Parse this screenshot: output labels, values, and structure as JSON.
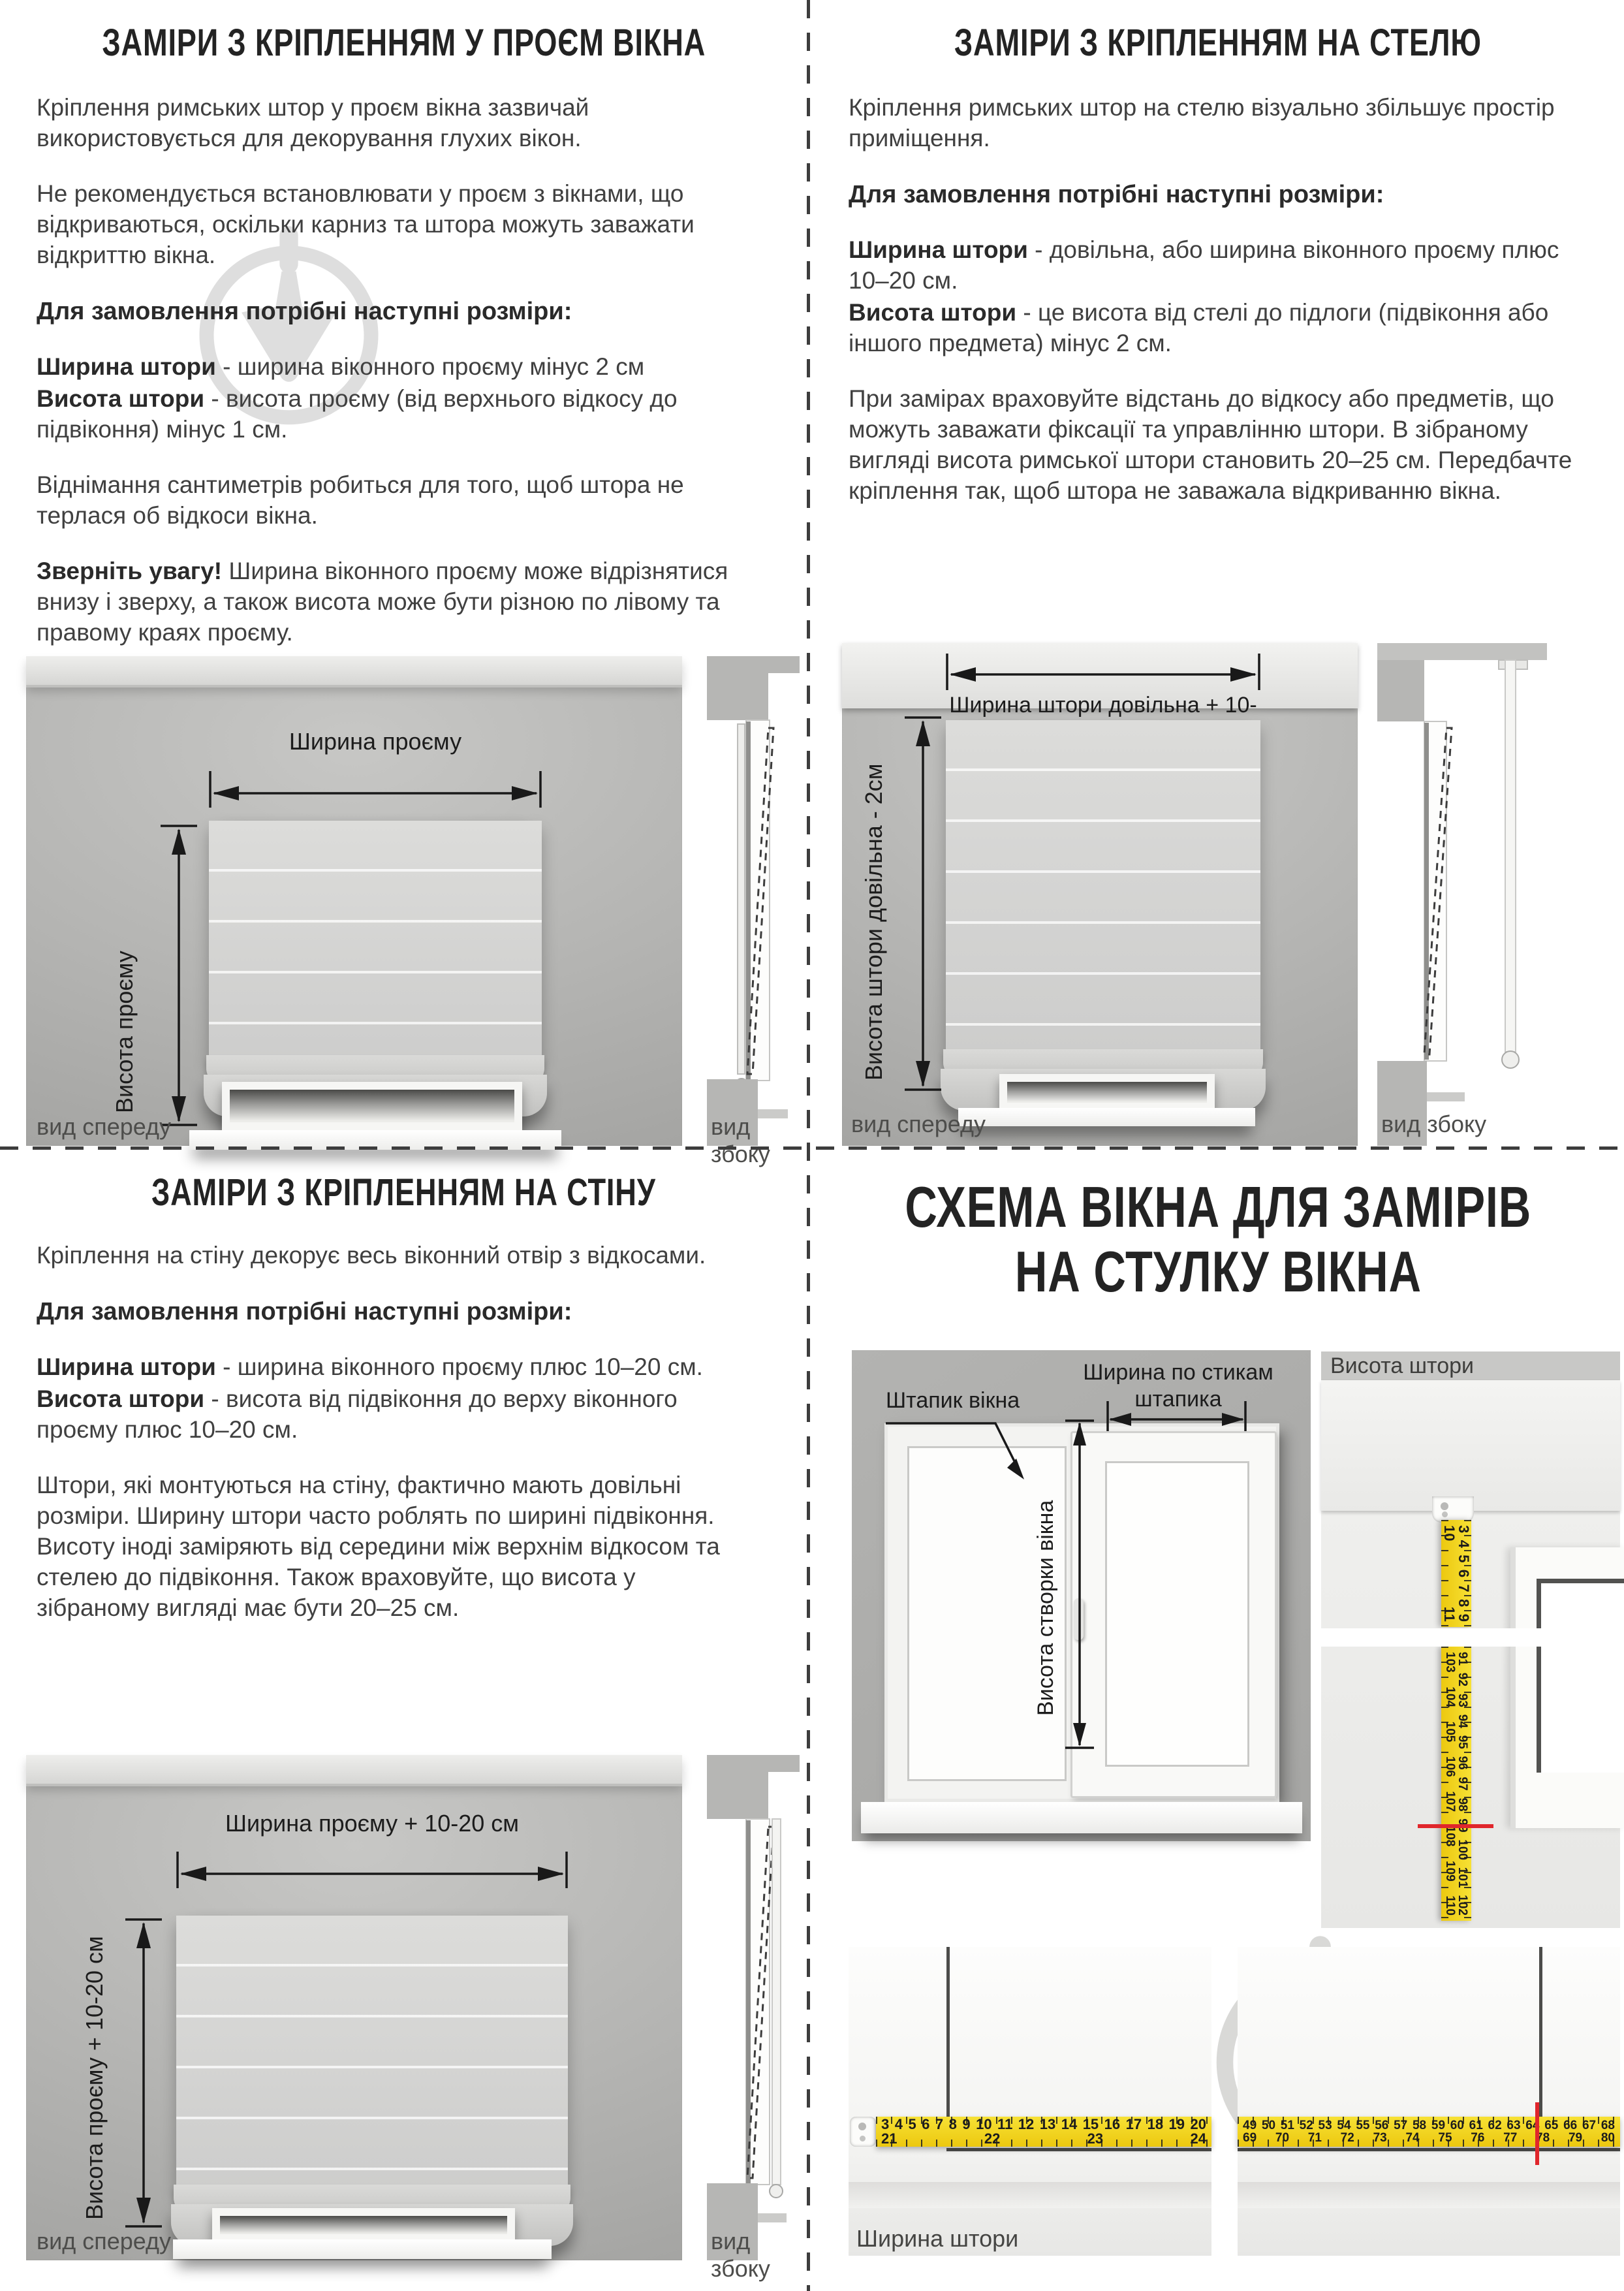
{
  "sections": {
    "opening": {
      "title": "ЗАМІРИ З КРІПЛЕННЯМ У ПРОЄМ ВІКНА",
      "intro": "Кріплення римських штор у проєм вікна зазвичай використовується для декорування глухих вікон.",
      "caution": "Не рекомендується встановлювати у проєм з вікнами, що відкриваються, оскільки карниз та штора можуть заважати відкриттю вікна.",
      "order_heading": "Для замовлення потрібні наступні розміри:",
      "sizes": [
        {
          "term": "Ширина штори",
          "desc": " - ширина віконного проєму мінус 2 см"
        },
        {
          "term": "Висота штори",
          "desc": " - висота проєму (від верхнього відкосу до підвіконня) мінус 1 см."
        }
      ],
      "explain": "Віднімання сантиметрів робиться для того, щоб штора не терлася об відкоси вікна.",
      "attention_lead": "Зверніть увагу!",
      "attention_text": " Ширина віконного проєму може відрізнятися внизу і зверху, а також висота може бути різною по лівому та правому краях проєму.",
      "dim_width_label": "Ширина проєму",
      "dim_height_label": "Висота проєму",
      "front_view_caption": "вид спереду",
      "side_view_caption": "вид збоку"
    },
    "ceiling": {
      "title": "ЗАМІРИ З КРІПЛЕННЯМ НА СТЕЛЮ",
      "intro": "Кріплення римських штор на стелю візуально збільшує простір приміщення.",
      "order_heading": "Для замовлення потрібні наступні розміри:",
      "sizes": [
        {
          "term": "Ширина штори",
          "desc": " - довільна, або ширина віконного проєму плюс 10–20 см."
        },
        {
          "term": "Висота штори",
          "desc": " - це висота від стелі до підлоги (підвіконня або іншого предмета) мінус 2 см."
        }
      ],
      "tips": "При замірах враховуйте відстань до відкосу або предметів, що можуть заважати фіксації та управлінню штори. В зібраному вигляді висота римської штори становить 20–25 см. Передбачте кріплення так, щоб штора не заважала відкриванню вікна.",
      "dim_width_label": "Ширина штори довільна + 10-20 см",
      "dim_height_label": "Висота штори довільна - 2см",
      "front_view_caption": "вид спереду",
      "side_view_caption": "вид збоку"
    },
    "wall": {
      "title": "ЗАМІРИ З КРІПЛЕННЯМ НА СТІНУ",
      "intro": "Кріплення на стіну декорує весь віконний отвір з відкосами.",
      "order_heading": "Для замовлення потрібні наступні розміри:",
      "sizes": [
        {
          "term": "Ширина штори",
          "desc": " - ширина віконного проєму плюс 10–20 см."
        },
        {
          "term": "Висота штори",
          "desc": " - висота від підвіконня до верху віконного проєму плюс 10–20 см."
        }
      ],
      "tips": "Штори, які монтуються на стіну, фактично мають довільні розміри. Ширину штори часто роблять по ширині підвіконня. Висоту іноді заміряють від середини між верхнім відкосом та стелею до підвіконня. Також враховуйте, що висота у зібраному вигляді має бути 20–25 см.",
      "dim_width_label": "Ширина проєму + 10-20 см",
      "dim_height_label": "Висота проєму + 10-20 см",
      "front_view_caption": "вид спереду",
      "side_view_caption": "вид збоку"
    },
    "sash": {
      "title_line1": "СХЕМА ВІКНА ДЛЯ ЗАМІРІВ",
      "title_line2": "НА СТУЛКУ ВІКНА",
      "bead_label": "Штапик вікна",
      "bead_width_label_line1": "Ширина по стикам",
      "bead_width_label_line2": "штапика",
      "sash_height_label": "Висота створки вікна",
      "curtain_height_label": "Висота штори",
      "curtain_width_label": "Ширина штори",
      "tape_vertical_top": "3 4 5 6 7 8 9 10 11",
      "tape_vertical_bottom": "91 92 93 94 95 96 97 98 99 100 101 102 103 104 105 106 107 108 109 110",
      "tape_horizontal_left": "3 4 5 6 7 8 9 10 11 12 13 14 15 16 17 18 19 20 21 22 23 24",
      "tape_horizontal_right": "49 50 51 52 53 54 55 56 57 58 59 60 61 62 63 64 65 66 67 68 69 70 71 72 73 74 75 76 77 78 79 80"
    }
  },
  "colors": {
    "tape_yellow": "#ecc80f",
    "red_mark": "#e0262b",
    "watermark_gray": "#dcdcdc",
    "wall_gray": "#b4b4b2",
    "text_dark": "#3a3a3a"
  }
}
